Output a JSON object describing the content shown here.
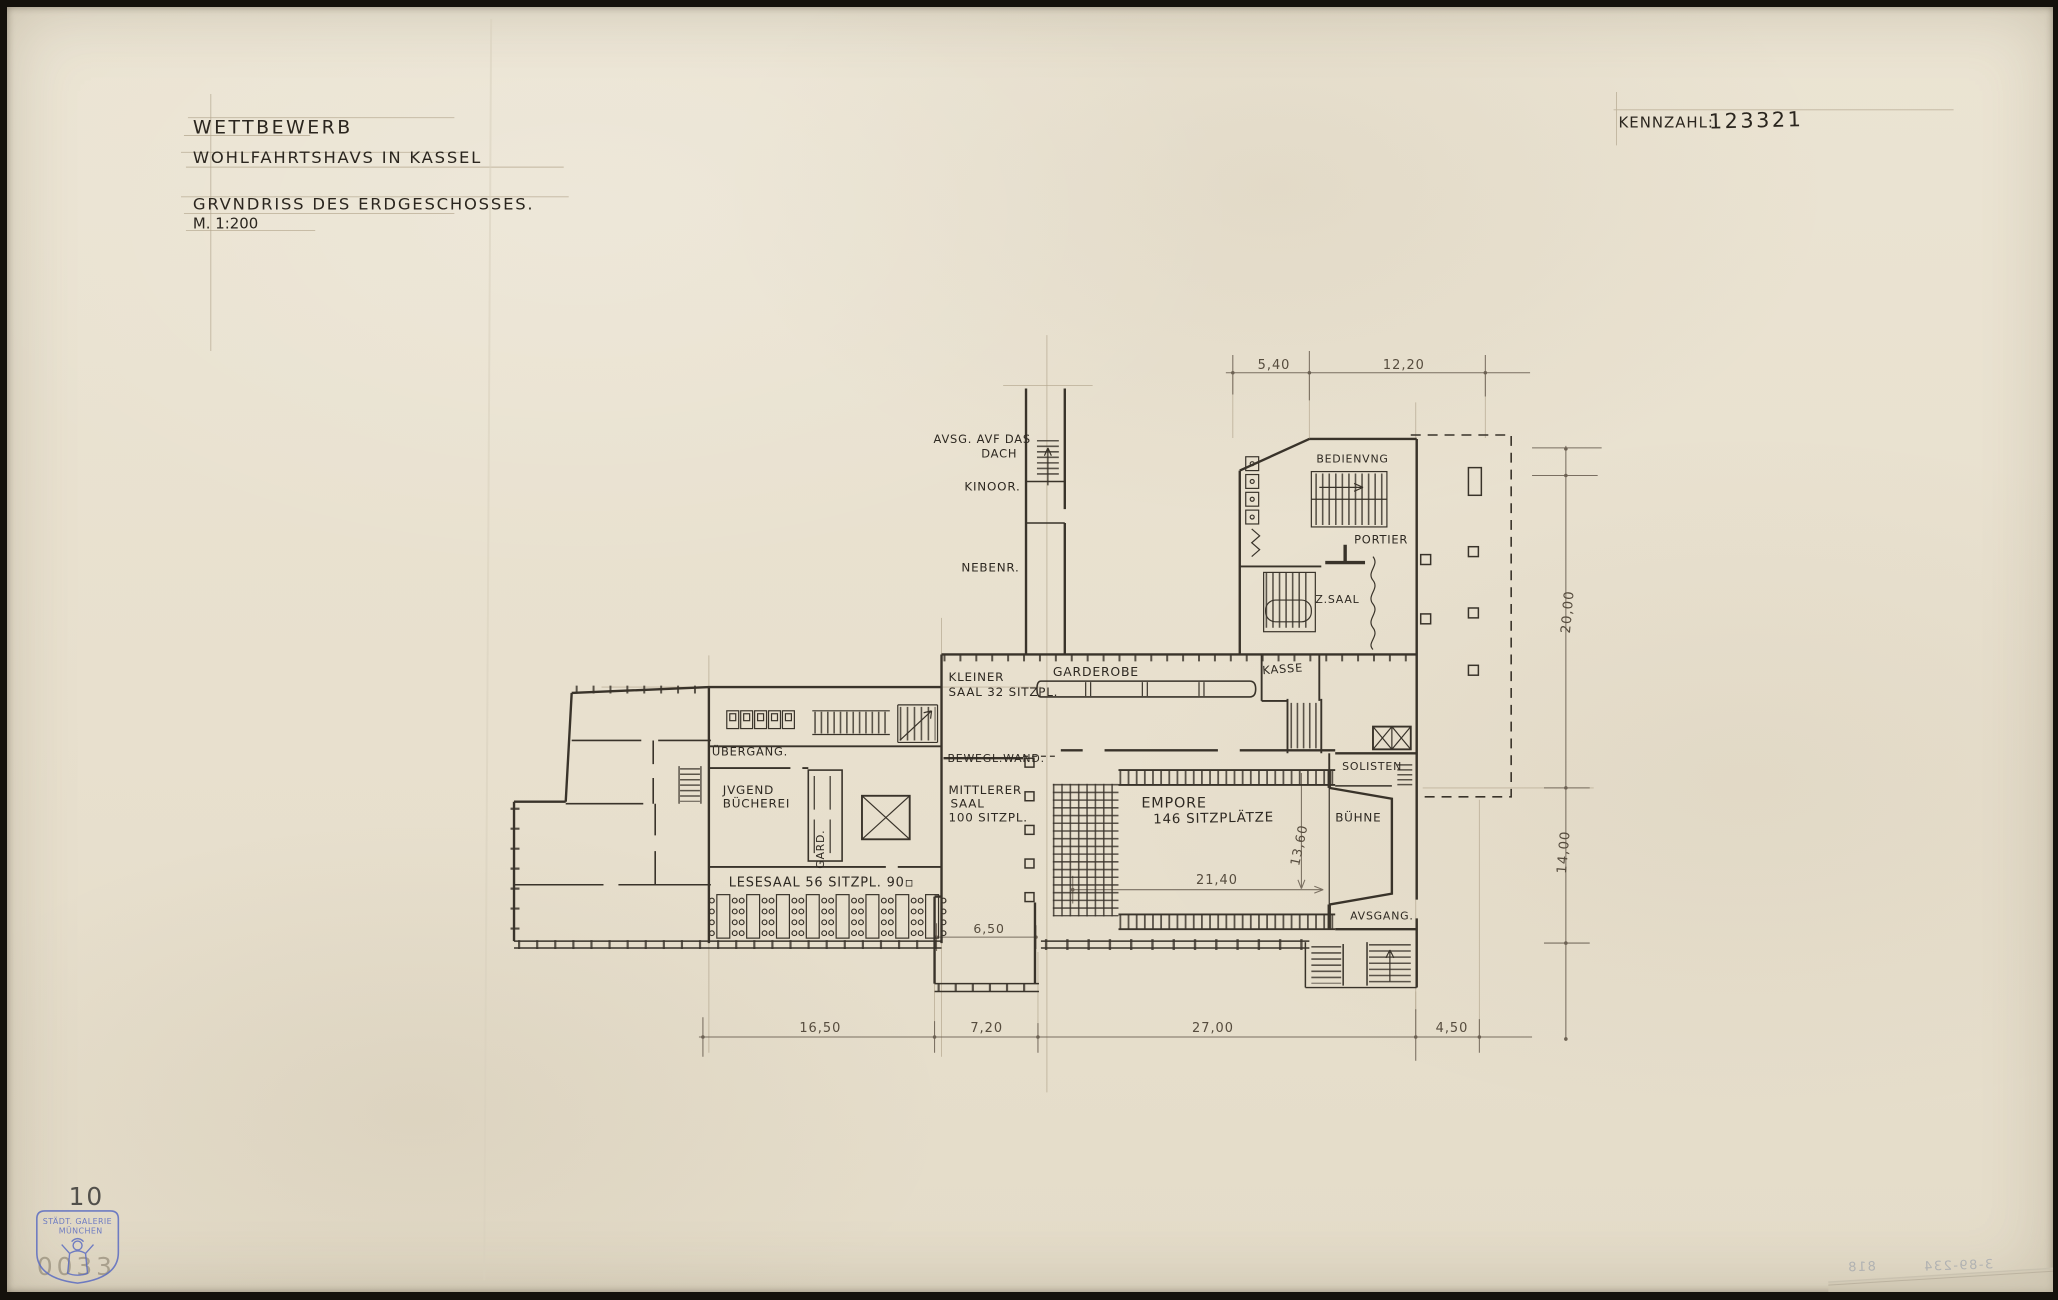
{
  "title_block": {
    "line1": "WETTBEWERB",
    "line2": "WOHLFAHRTSHAVS IN KASSEL",
    "line3": "GRVNDRISS DES ERDGESCHOSSES.",
    "line4": "M. 1:200"
  },
  "kennzahl": {
    "label": "KENNZAHL:",
    "value": "123321"
  },
  "rooms": {
    "exit_roof_1": "AVSG. AVF DAS",
    "exit_roof_2": "DACH",
    "kino": "KINOOR.",
    "side_room": "NEBENR.",
    "service": "BEDIENVNG",
    "porter": "PORTIER",
    "to_hall": "Z.SAAL",
    "small_hall_1": "KLEINER",
    "small_hall_2": "SAAL 32 SITZPL.",
    "cloakroom": "GARDEROBE",
    "ticket": "KASSE",
    "movable_wall": "BEWEGL.WAND.",
    "passage": "ÜBERGANG.",
    "youth_lib_1": "JVGEND",
    "youth_lib_2": "BÜCHEREI",
    "wardrobe": "GARD.",
    "middle_hall_1": "MITTLERER",
    "middle_hall_2": "SAAL",
    "middle_hall_3": "100 SITZPL.",
    "reading_room": "LESESAAL 56 SITZPL. 90▫",
    "gallery_1": "EMPORE",
    "gallery_2": "146 SITZPLÄTZE",
    "stage": "BÜHNE",
    "soloists": "SOLISTEN",
    "exit": "AVSGANG."
  },
  "dimensions": {
    "top_left": "5,40",
    "top_right": "12,20",
    "right_upper": "20,00",
    "right_lower": "14,00",
    "bottom_1": "16,50",
    "bottom_2": "7,20",
    "bottom_3": "27,00",
    "bottom_4": "4,50",
    "hall_width": "21,40",
    "hall_depth": "13,60",
    "annex_width": "6,50"
  },
  "stamps": {
    "page_number": "10",
    "gallery_stamp_line1": "STÄDT. GALERIE",
    "gallery_stamp_line2": "MÜNCHEN",
    "inventory_number": "0033",
    "pencil_note": "3-89-234",
    "pencil_note_2": "818"
  }
}
